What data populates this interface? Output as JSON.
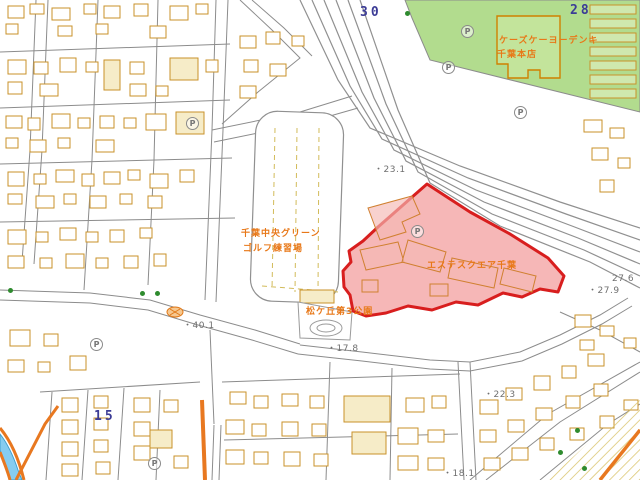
{
  "map": {
    "colors": {
      "green_zone": "#b2dc8e",
      "parcel_fill": "#f08a8a",
      "parcel_border": "#d81e1e",
      "building_outline": "#c8922a",
      "building_fill": "#f6ecc8",
      "road_major": "#e87820",
      "road_minor": "#8c8c8c",
      "water": "#86ccf0",
      "label_orange": "#e87818",
      "label_navy": "#3c3c96",
      "label_gray": "#6f6f6f"
    },
    "parking_glyph": "P",
    "labels": [
      {
        "name": "sheet-number-30",
        "text": "30",
        "x": 360,
        "y": 6,
        "cls": "navy",
        "size": 13
      },
      {
        "name": "sheet-number-28",
        "text": "28",
        "x": 570,
        "y": 4,
        "cls": "navy",
        "size": 13
      },
      {
        "name": "sheet-number-15",
        "text": "15",
        "x": 94,
        "y": 410,
        "cls": "navy",
        "size": 13
      },
      {
        "name": "store-name-line1",
        "text": "ケーズケーヨーデンキ",
        "x": 499,
        "y": 37,
        "cls": "orange",
        "size": 9
      },
      {
        "name": "store-name-line2",
        "text": "千葉本店",
        "x": 497,
        "y": 51,
        "cls": "orange",
        "size": 9
      },
      {
        "name": "golf-range-name-line1",
        "text": "千葉中央グリーン",
        "x": 241,
        "y": 230,
        "cls": "orange",
        "size": 9
      },
      {
        "name": "golf-range-name-line2",
        "text": "ゴルフ練習場",
        "x": 243,
        "y": 245,
        "cls": "orange",
        "size": 9
      },
      {
        "name": "parcel-building-name",
        "text": "エステスクエア千葉",
        "x": 427,
        "y": 262,
        "cls": "orange",
        "size": 9
      },
      {
        "name": "park-name",
        "text": "松ケ丘第3公園",
        "x": 306,
        "y": 308,
        "cls": "orange",
        "size": 9
      },
      {
        "name": "elevation-23-1",
        "text": "・23.1",
        "x": 374,
        "y": 166,
        "cls": "gray",
        "size": 9
      },
      {
        "name": "elevation-27-6",
        "text": "27.6",
        "x": 612,
        "y": 275,
        "cls": "gray",
        "size": 9
      },
      {
        "name": "elevation-27-9",
        "text": "・27.9",
        "x": 588,
        "y": 287,
        "cls": "gray",
        "size": 9
      },
      {
        "name": "elevation-40-1",
        "text": "・40.1",
        "x": 183,
        "y": 322,
        "cls": "gray",
        "size": 9
      },
      {
        "name": "elevation-17-8",
        "text": "・17.8",
        "x": 327,
        "y": 345,
        "cls": "gray",
        "size": 9
      },
      {
        "name": "elevation-22-3",
        "text": "・22.3",
        "x": 484,
        "y": 391,
        "cls": "gray",
        "size": 9
      },
      {
        "name": "elevation-18-1",
        "text": "・18.1",
        "x": 443,
        "y": 470,
        "cls": "gray",
        "size": 9
      }
    ],
    "parking": [
      {
        "x": 461,
        "y": 25
      },
      {
        "x": 442,
        "y": 61
      },
      {
        "x": 514,
        "y": 106
      },
      {
        "x": 186,
        "y": 117
      },
      {
        "x": 411,
        "y": 225
      },
      {
        "x": 90,
        "y": 338
      },
      {
        "x": 148,
        "y": 457
      }
    ],
    "vegetation": [
      {
        "x": 405,
        "y": 11
      },
      {
        "x": 8,
        "y": 288
      },
      {
        "x": 140,
        "y": 291
      },
      {
        "x": 155,
        "y": 291
      },
      {
        "x": 575,
        "y": 428
      },
      {
        "x": 582,
        "y": 466
      },
      {
        "x": 558,
        "y": 450
      }
    ]
  }
}
